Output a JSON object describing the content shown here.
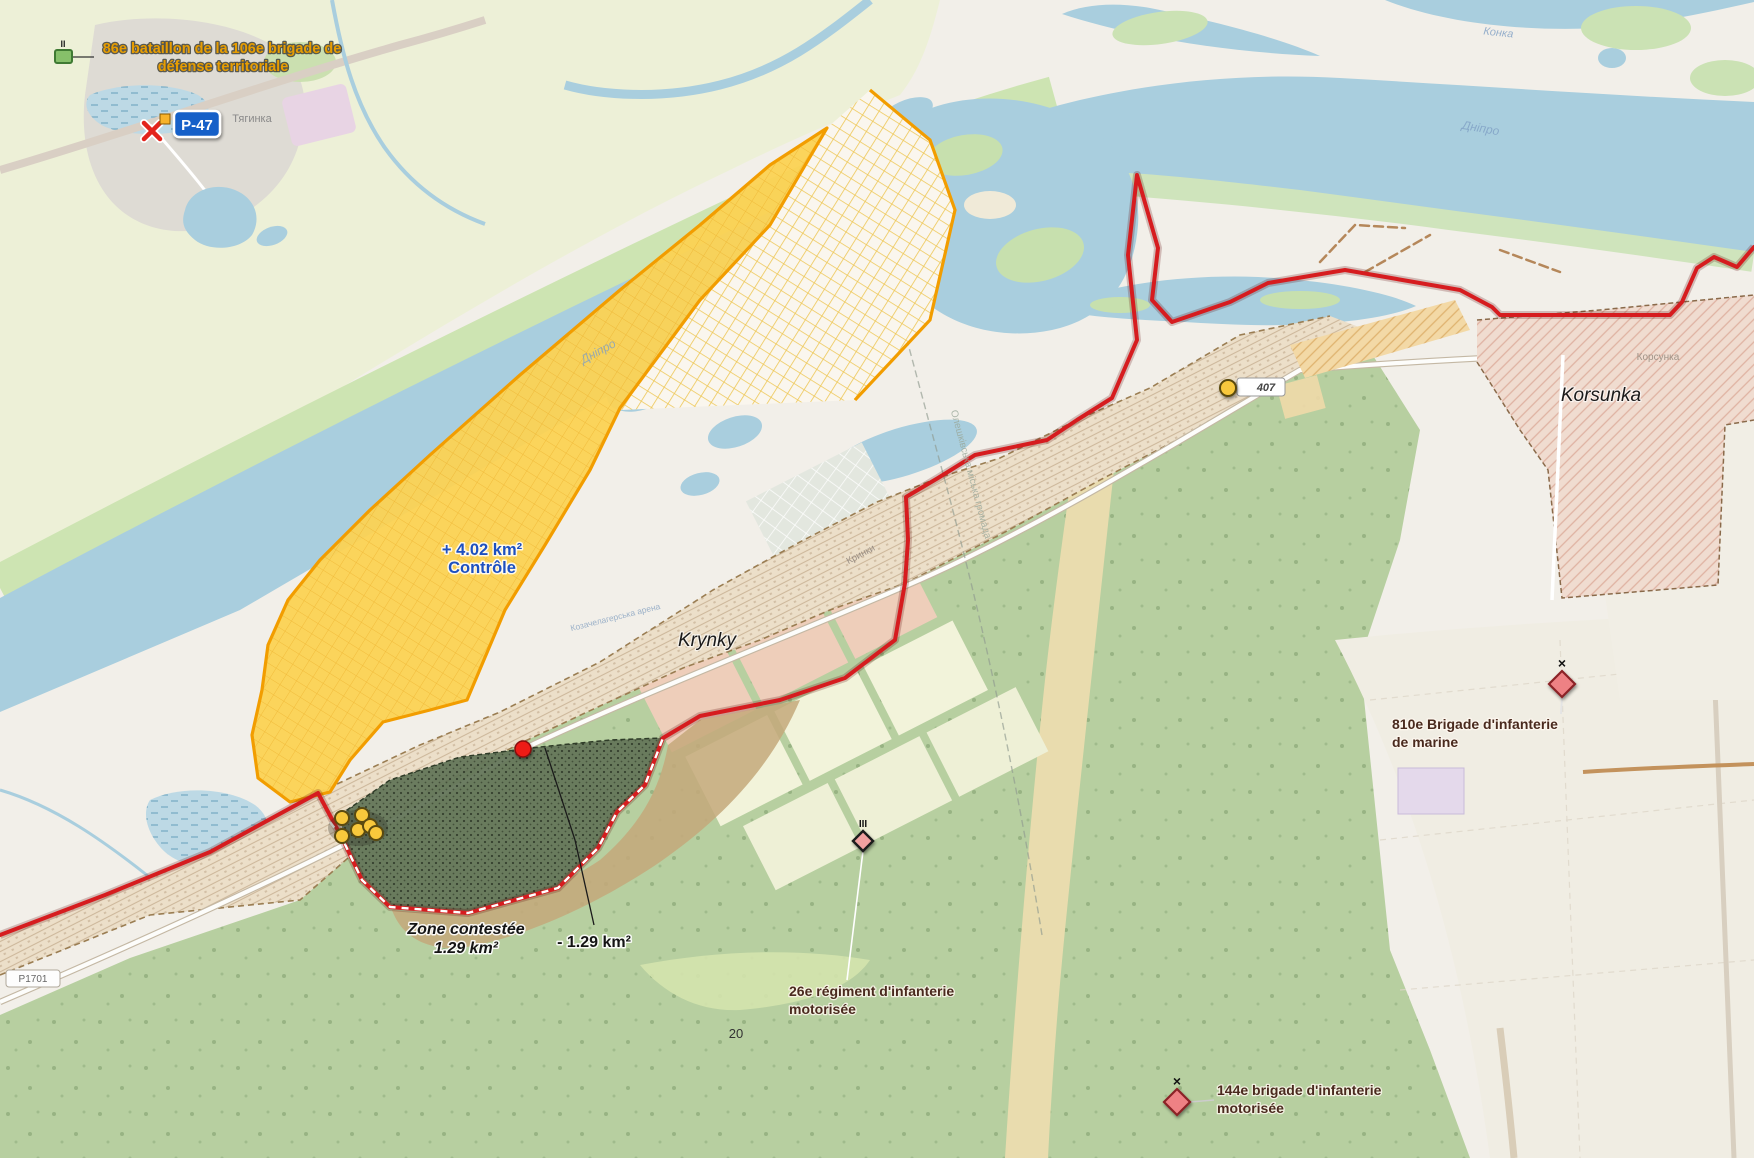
{
  "map": {
    "places": {
      "krynky": "Krynky",
      "korsunka": "Korsunka",
      "tiahynka_ua": "Тягинка",
      "krynky_ua": "Кринки",
      "korsunka_ua": "Корсунка",
      "dnipro_river_ua": "Дніпро",
      "konka_river_ua": "Конка",
      "hromada_ua": "Олешківська міська громада",
      "nature_area_ua": "Козачелагерська арена",
      "plot_number": "20"
    },
    "roads": {
      "p47_ref": "P-47",
      "ref_small": "407",
      "ref_bottom": "Р1701"
    },
    "zones": {
      "control": {
        "delta_area": "+ 4.02 km²",
        "status": "Contrôle",
        "fill": "#fbd253",
        "border": "#f29d00",
        "label_color": "#1d50c0"
      },
      "contested": {
        "name": "Zone contestée",
        "area": "1.29 km²",
        "fill": "#64765a"
      },
      "lost": {
        "delta_area": "- 1.29 km²"
      },
      "frontline_color": "#d61c1f"
    },
    "units": [
      {
        "id": "86e-bataillon",
        "echelon": "II",
        "name_line1": "86e bataillon de la 106e brigade de",
        "name_line2": "défense territoriale",
        "side": "friendly",
        "label_color": "#e89d00"
      },
      {
        "id": "810e-brigade",
        "echelon": "×",
        "name_line1": "810e Brigade d'infanterie",
        "name_line2": "de marine",
        "side": "enemy",
        "label_color": "#4a2a1e"
      },
      {
        "id": "26e-regiment",
        "echelon": "III",
        "name_line1": "26e régiment d'infanterie",
        "name_line2": "motorisée",
        "side": "enemy",
        "label_color": "#4a2a1e"
      },
      {
        "id": "144e-brigade",
        "echelon": "×",
        "name_line1": "144e brigade d'infanterie",
        "name_line2": "motorisée",
        "side": "enemy",
        "label_color": "#4a2a1e"
      }
    ]
  }
}
